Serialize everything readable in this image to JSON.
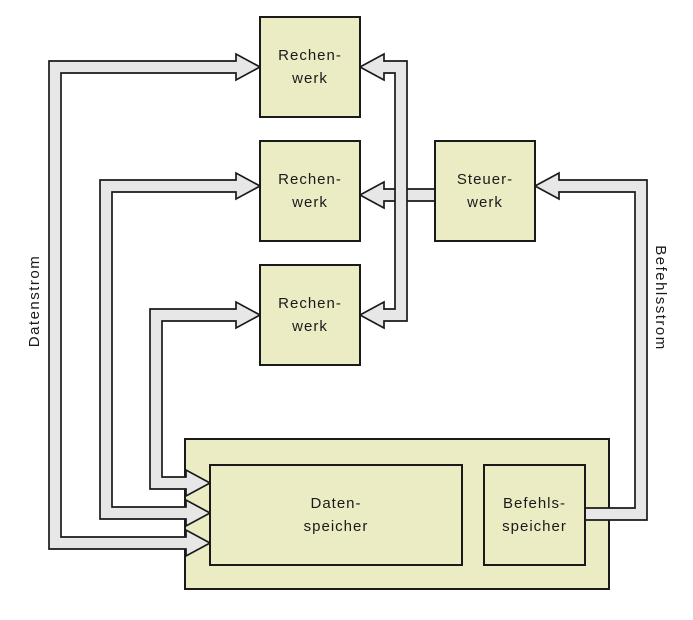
{
  "boxes": {
    "rechenwerk_top": {
      "line1": "Rechen-",
      "line2": "werk"
    },
    "rechenwerk_middle": {
      "line1": "Rechen-",
      "line2": "werk"
    },
    "rechenwerk_bottom": {
      "line1": "Rechen-",
      "line2": "werk"
    },
    "steuerwerk": {
      "line1": "Steuer-",
      "line2": "werk"
    },
    "datenspeicher": {
      "line1": "Daten-",
      "line2": "speicher"
    },
    "befehlsspeicher": {
      "line1": "Befehls-",
      "line2": "speicher"
    }
  },
  "streams": {
    "data_label": "Datenstrom",
    "instruction_label": "Befehlsstrom"
  },
  "colors": {
    "box_fill": "#ebecc4",
    "box_border": "#1a1a1a",
    "arrow_fill": "#e7e7e7",
    "arrow_outline": "#1a1a1a",
    "background": "#ffffff"
  }
}
